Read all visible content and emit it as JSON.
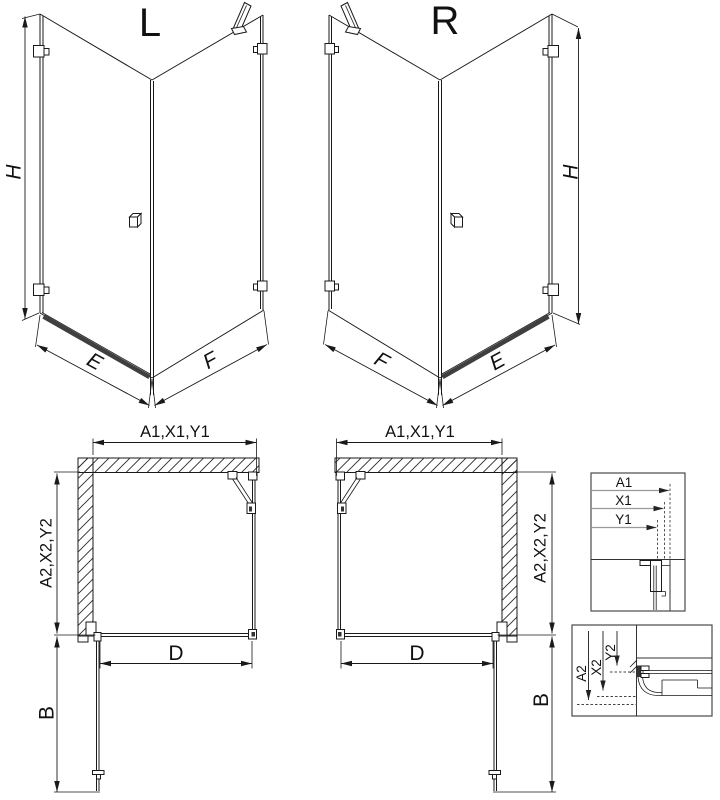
{
  "drawing": {
    "iso_left": {
      "label": "L",
      "height_dim": "H",
      "door_width_dim": "E",
      "side_width_dim": "F"
    },
    "iso_right": {
      "label": "R",
      "height_dim": "H",
      "door_width_dim": "E",
      "side_width_dim": "F"
    },
    "plan_left": {
      "top_dim": "A1,X1,Y1",
      "side_dim": "A2,X2,Y2",
      "door_dim": "D",
      "swing_dim": "B"
    },
    "plan_right": {
      "top_dim": "A1,X1,Y1",
      "side_dim": "A2,X2,Y2",
      "door_dim": "D",
      "swing_dim": "B"
    },
    "detail_wall_profile": {
      "dim_a1": "A1",
      "dim_x1": "X1",
      "dim_y1": "Y1"
    },
    "detail_floor_profile": {
      "dim_a2": "A2",
      "dim_x2": "X2",
      "dim_y2": "Y2"
    }
  },
  "colors": {
    "line": "#1a1a1a",
    "detail_box": "#4a4a4a",
    "detail_arrow_line": "#999999",
    "threshold": "#3f3f3f",
    "background": "#ffffff"
  }
}
